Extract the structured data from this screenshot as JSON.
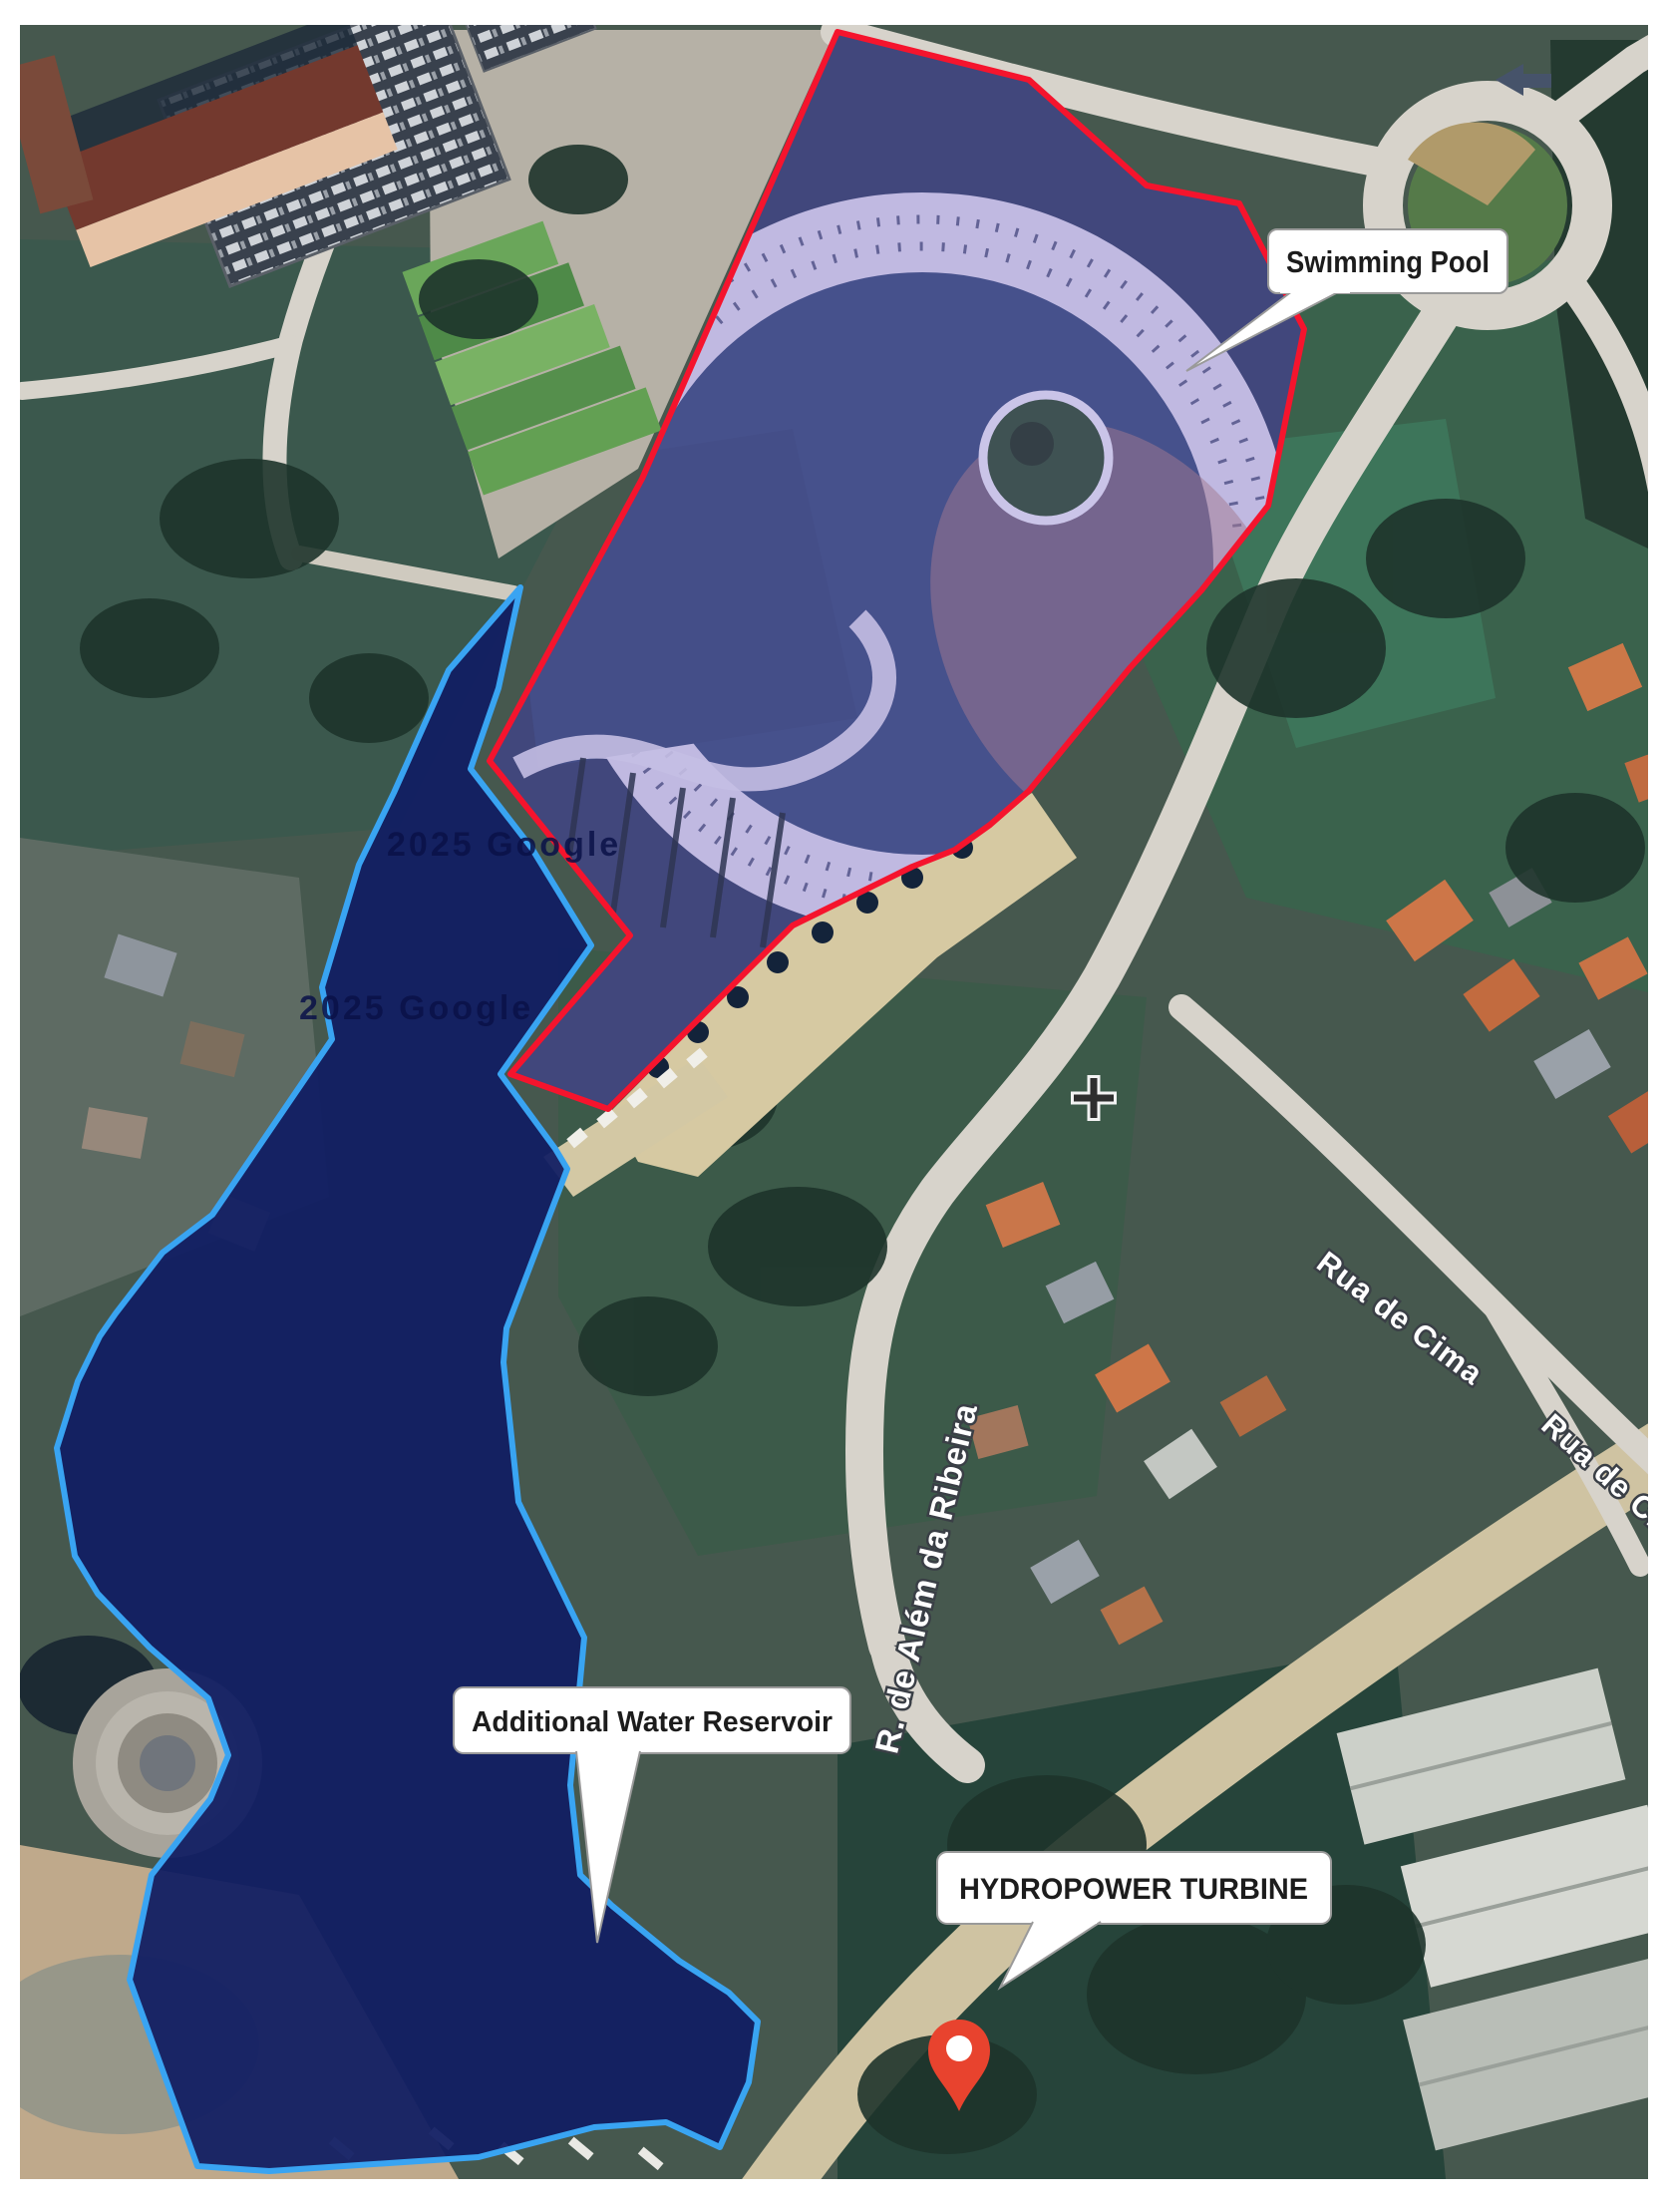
{
  "map": {
    "view": "satellite",
    "callouts": {
      "swimming_pool": "Swimming Pool",
      "additional_water_reservoir": "Additional Water Reservoir",
      "hydropower_turbine": "HYDROPOWER TURBINE"
    },
    "streets": {
      "rua_de_cima": "Rua de Cima",
      "rua_de_cima_lower": "Rua de Cima",
      "alem_da_ribeira": "R. de Além da Ribeira"
    },
    "watermark": "2025 Google",
    "colors": {
      "pool_outline": "#f5142d",
      "reservoir_outline": "#39a4f2",
      "reservoir_fill": "#111e63",
      "pin": "#e8432e",
      "callout_bg": "#ffffff",
      "callout_text": "#1c1c1c",
      "street_text": "#ffffff"
    }
  }
}
